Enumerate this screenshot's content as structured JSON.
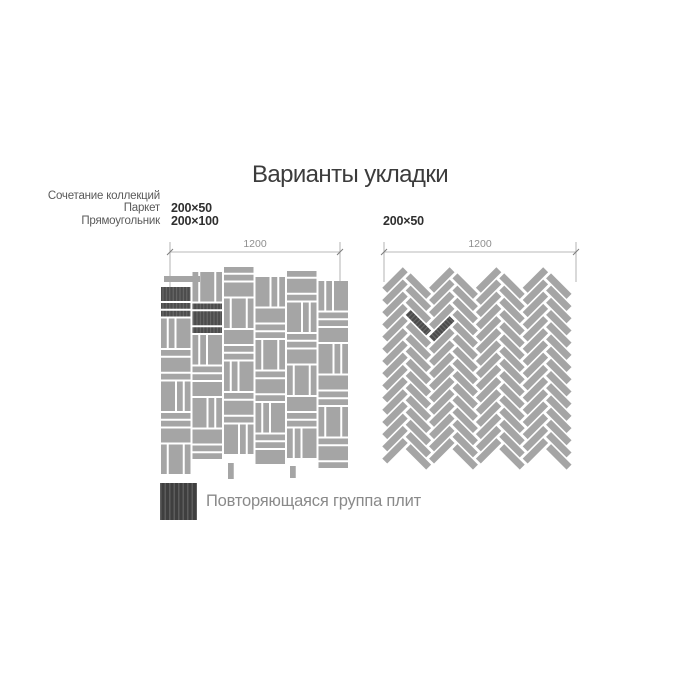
{
  "title": "Варианты укладки",
  "collection_note": {
    "lines": [
      "Сочетание коллекций",
      "Паркет",
      "Прямоугольник"
    ]
  },
  "left_diagram": {
    "name": "Паркет (корзинка) из плит двух форматов",
    "pattern": "parquet-basketweave",
    "sizes": [
      "200×50",
      "200×100"
    ],
    "dimension": "1200"
  },
  "right_diagram": {
    "name": "Ёлочка (herringbone) из плит одного формата",
    "pattern": "herringbone",
    "sizes": [
      "200×50"
    ],
    "dimension": "1200"
  },
  "legend": {
    "label": "Повторяющаяся группа плит",
    "swatch": "dark-striped-tile"
  },
  "colors": {
    "tile": "#a5a5a5",
    "tile_dark": "#4c4c4c",
    "stripe": "#6e6e6e",
    "dim": "#a0a0a0",
    "tick": "#7d7d7d",
    "title": "#3c3c3c",
    "label": "#5a5a5a",
    "bold": "#2f2f2f",
    "dim_text": "#8f8f8f",
    "legend_text": "#8a8a8a"
  }
}
